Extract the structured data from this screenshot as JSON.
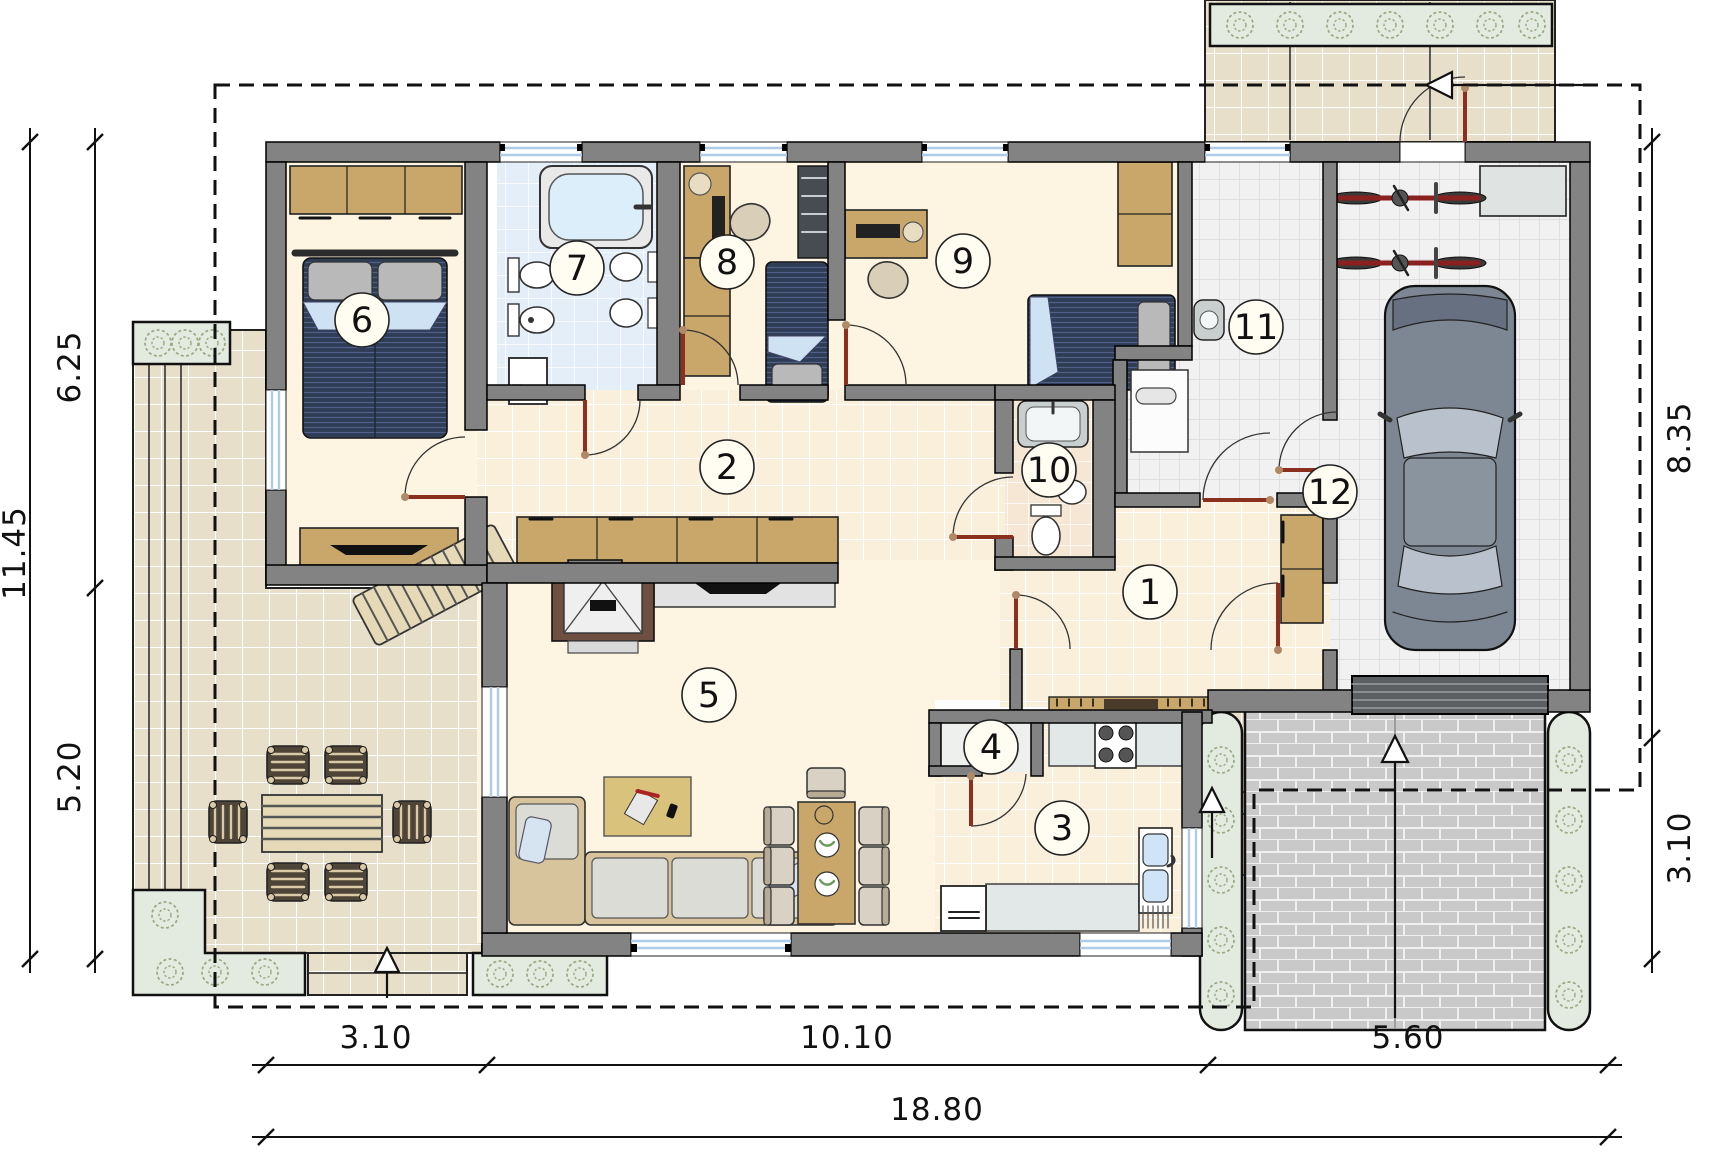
{
  "rooms": [
    {
      "number": "1"
    },
    {
      "number": "2"
    },
    {
      "number": "3"
    },
    {
      "number": "4"
    },
    {
      "number": "5"
    },
    {
      "number": "6"
    },
    {
      "number": "7"
    },
    {
      "number": "8"
    },
    {
      "number": "9"
    },
    {
      "number": "10"
    },
    {
      "number": "11"
    },
    {
      "number": "12"
    }
  ],
  "dims": {
    "left_total": "11.45",
    "left": [
      "6.25",
      "5.20"
    ],
    "right": [
      "8.35",
      "3.10"
    ],
    "bottom": [
      "3.10",
      "10.10",
      "5.60"
    ],
    "bottom_total": "18.80"
  },
  "palette": {
    "wall": "#838383",
    "door_leaf": "#8b2f1f",
    "bed_navy": "#2e3c55",
    "wood_tan": "#c9a76a",
    "tile_warm": "#e8dfcb",
    "tile_cream": "#f8efdb",
    "tile_bath": "#e3eef9",
    "tile_wc": "#f6e7d4",
    "tile_gray": "#f1f1f1",
    "paving_brick": "#cacaca",
    "planter": "#e3eae0",
    "plant_stroke": "#9aa87f",
    "window_glass": "#aecbe8"
  }
}
